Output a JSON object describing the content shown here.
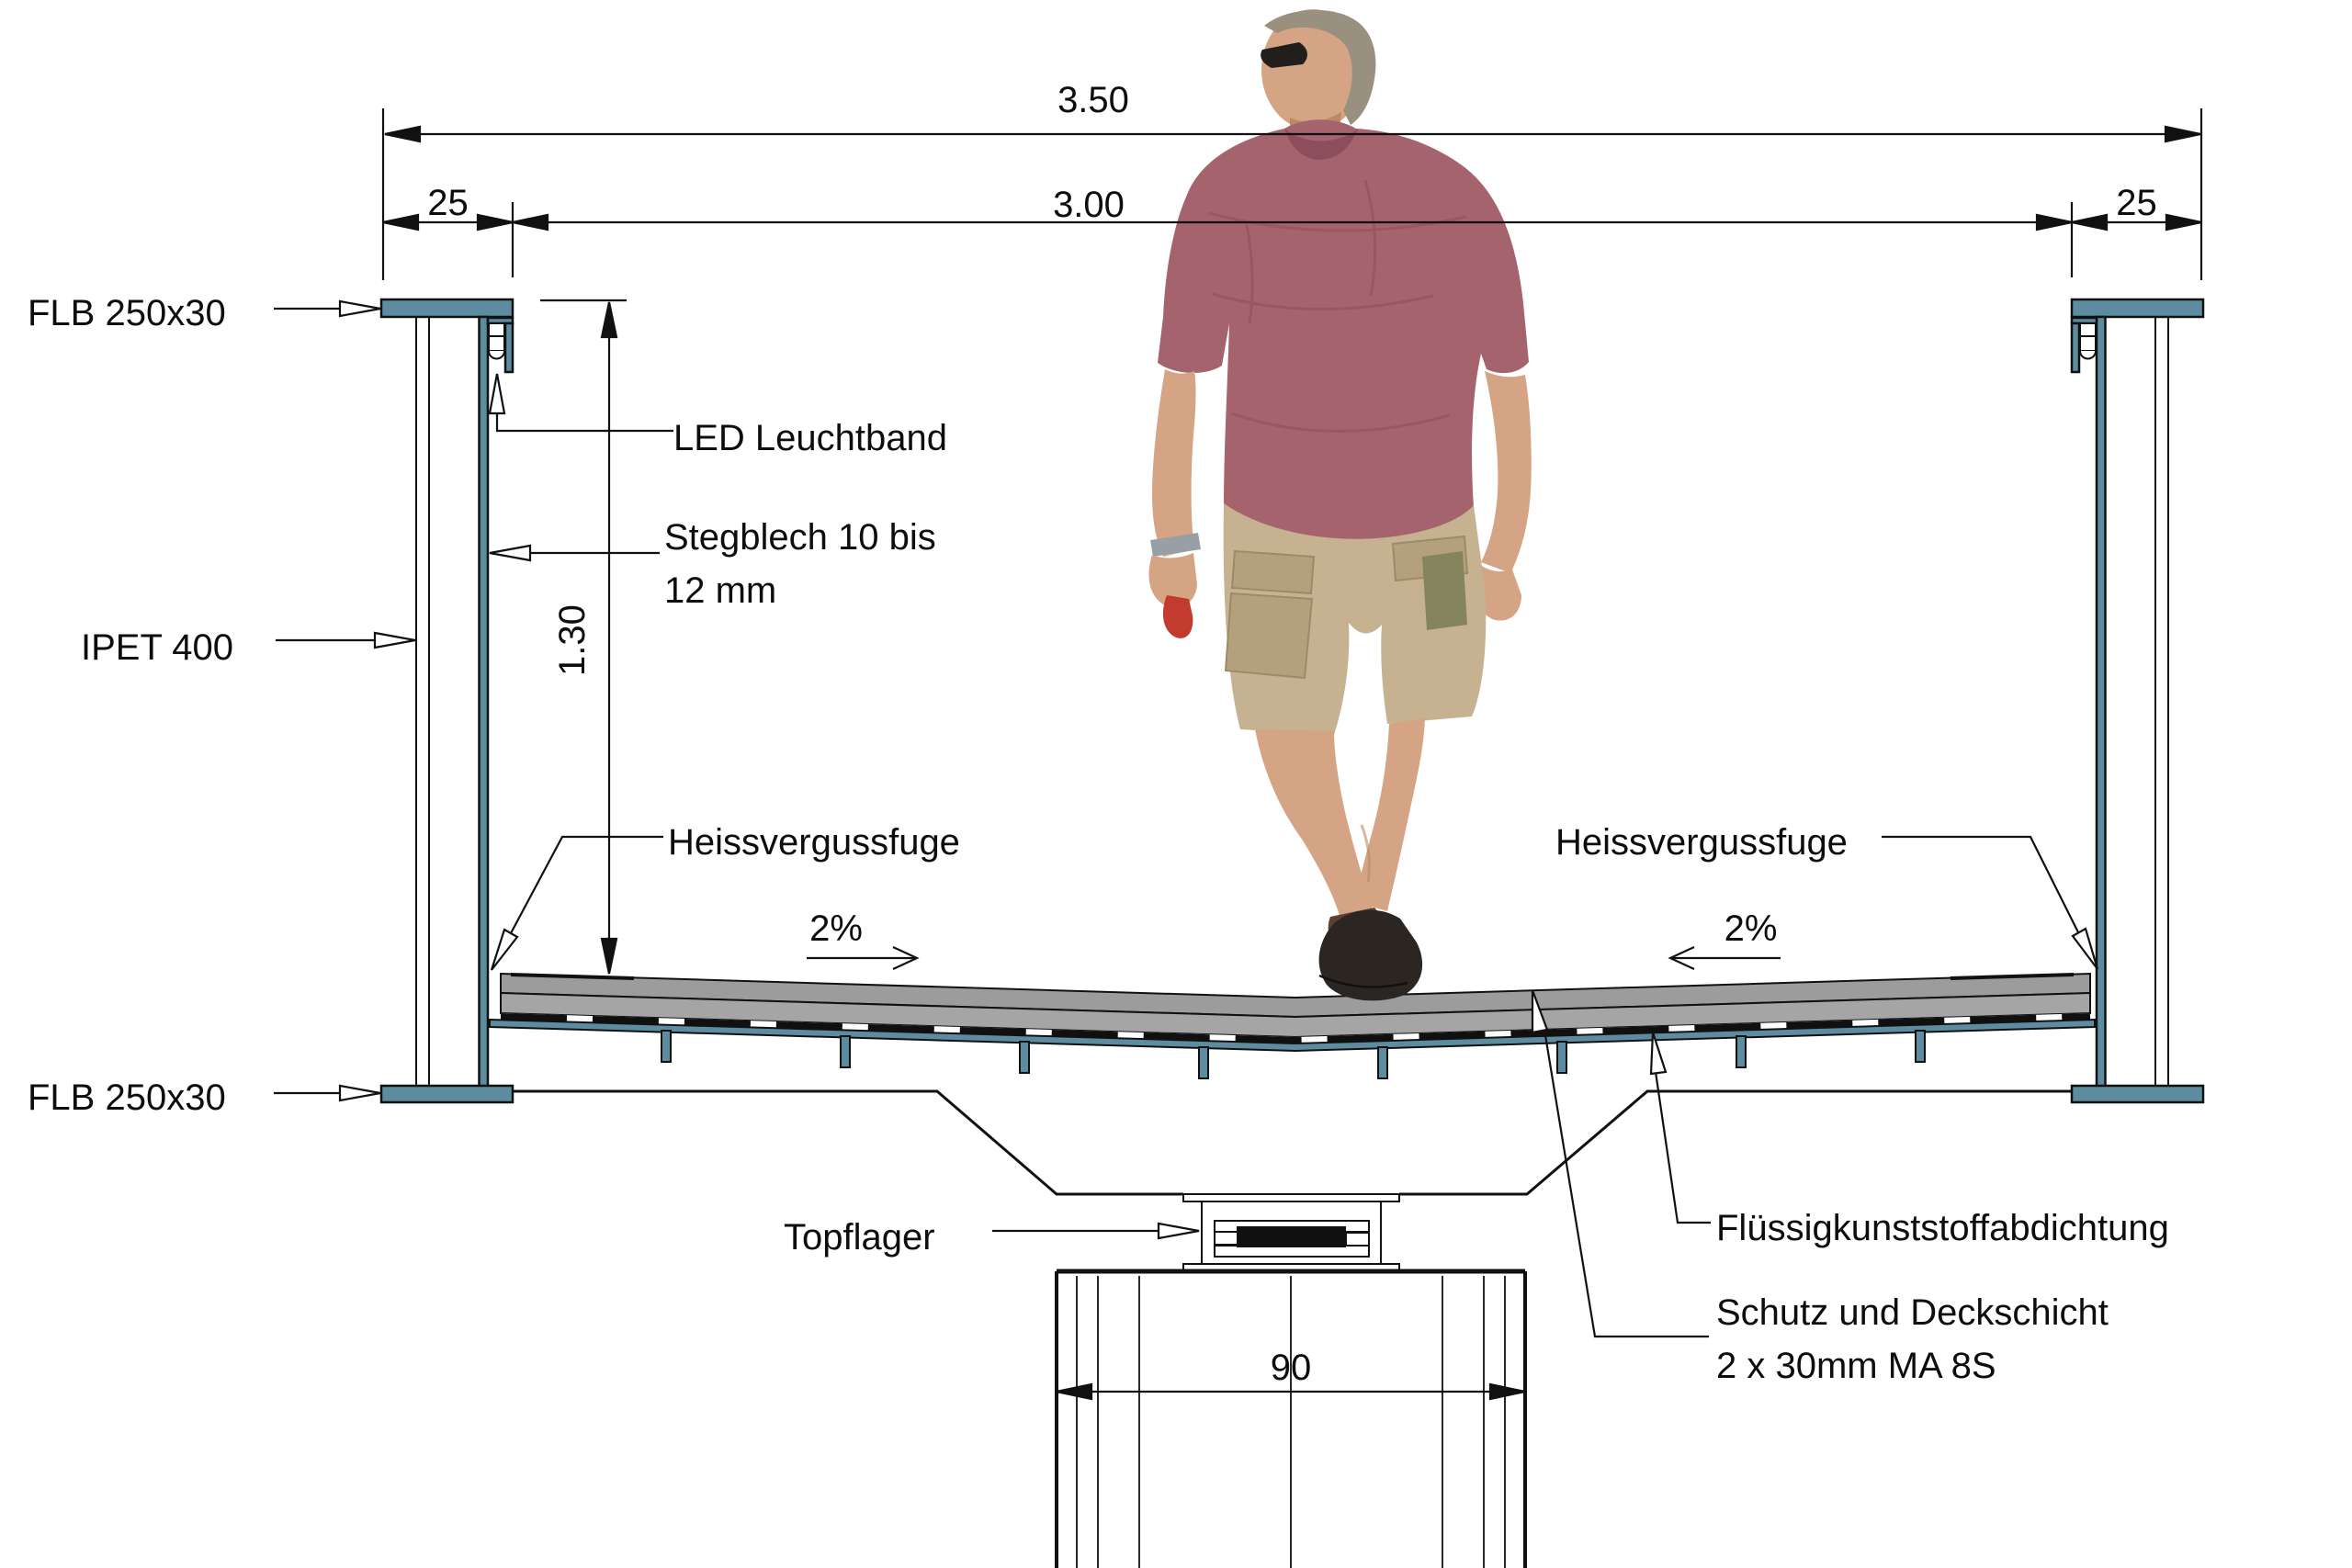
{
  "drawing": {
    "title": "Querschnitt Fussgaengerbruecke",
    "dimensions": {
      "total_width": "3.50",
      "clear_width": "3.00",
      "flange_width_left": "25",
      "flange_width_right": "25",
      "girder_height": "1.30",
      "pier_width": "90"
    },
    "slopes": {
      "left": "2%",
      "right": "2%"
    },
    "labels": {
      "flb_top_left": "FLB 250x30",
      "led": "LED Leuchtband",
      "web_plate_1": "Stegblech 10 bis",
      "web_plate_2": "12 mm",
      "column": "IPET 400",
      "joint_left": "Heissvergussfuge",
      "joint_right": "Heissvergussfuge",
      "flb_bottom_left": "FLB 250x30",
      "bearing": "Topflager",
      "waterproofing": "Flüssigkunststoffabdichtung",
      "surfacing_1": "Schutz und Deckschicht",
      "surfacing_2": "2 x 30mm MA 8S"
    },
    "colors": {
      "steel": "#5D8CA0",
      "gray1": "#9C9C9C",
      "gray2": "#A5A5A5",
      "sealing": "#101010",
      "line": "#111111",
      "shirt": "#A5636E",
      "shirtdark": "#8C4E5B",
      "skin": "#D4A484",
      "skindark": "#BA8A68",
      "shorts": "#C6B290",
      "pocket": "#B5A07E",
      "olive": "#84855C",
      "hair": "#99907F",
      "shoes": "#2B2622",
      "sandal": "#5C4132",
      "watch": "#98A0A6",
      "red_item": "#C23B2E"
    }
  }
}
